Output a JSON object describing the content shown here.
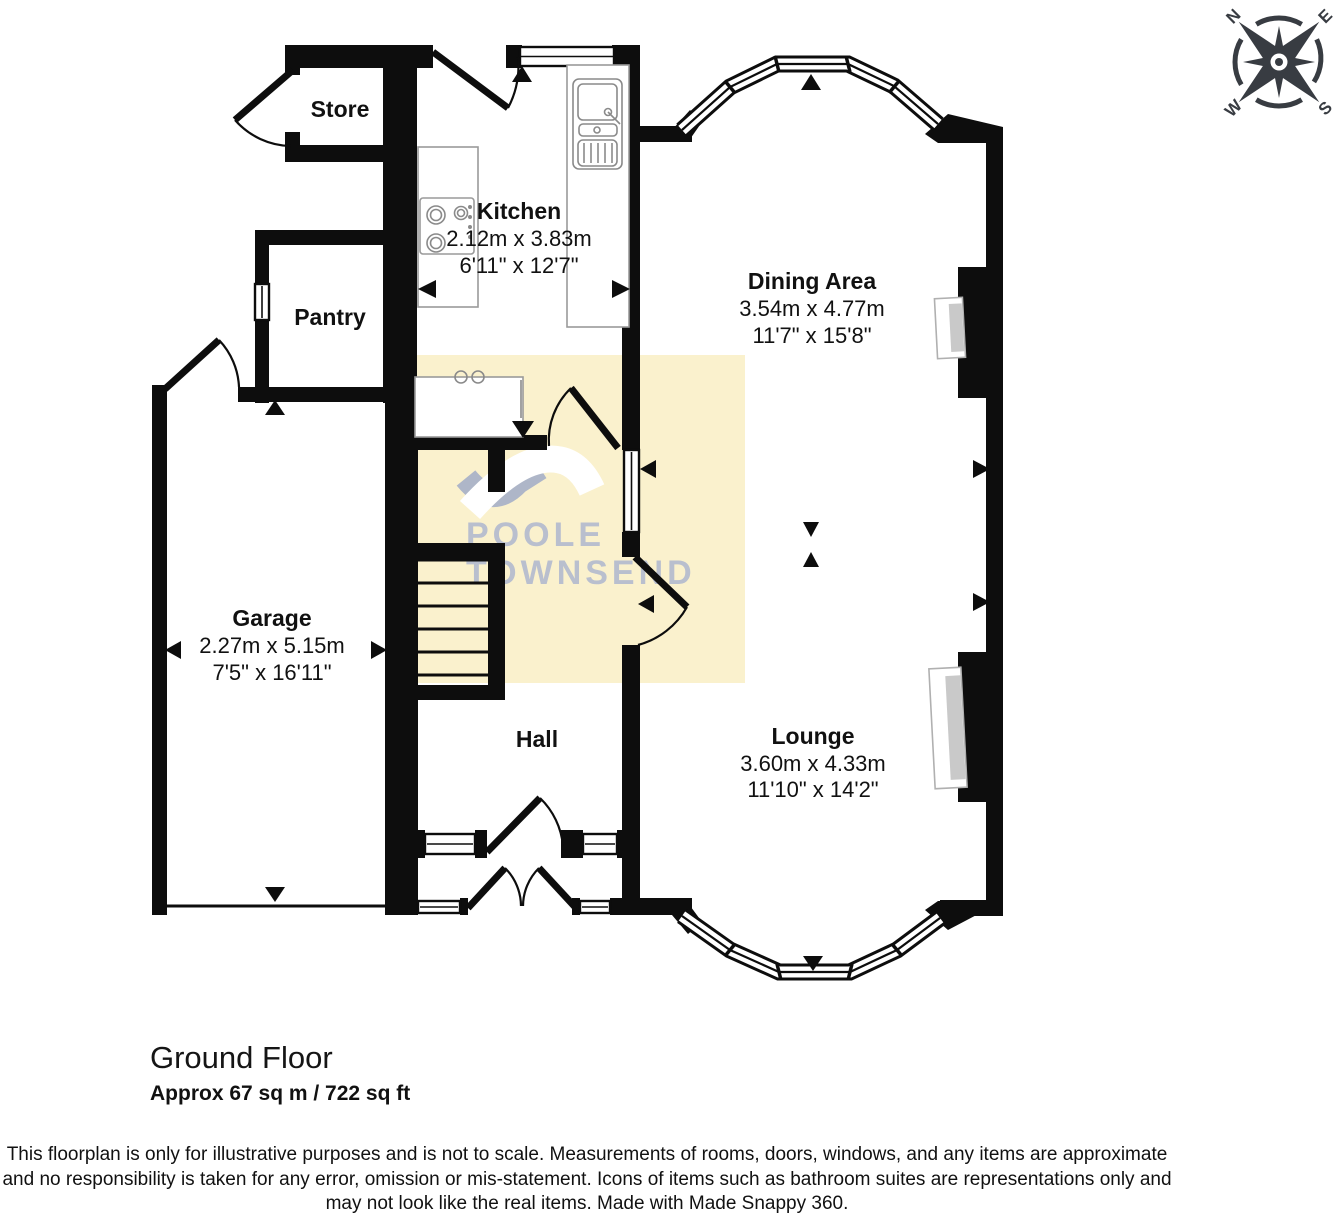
{
  "rooms": {
    "store": {
      "name": "Store"
    },
    "kitchen": {
      "name": "Kitchen",
      "metric": "2.12m x 3.83m",
      "imperial": "6'11\" x 12'7\""
    },
    "pantry": {
      "name": "Pantry"
    },
    "dining": {
      "name": "Dining Area",
      "metric": "3.54m x 4.77m",
      "imperial": "11'7\" x 15'8\""
    },
    "garage": {
      "name": "Garage",
      "metric": "2.27m x 5.15m",
      "imperial": "7'5\" x 16'11\""
    },
    "hall": {
      "name": "Hall"
    },
    "lounge": {
      "name": "Lounge",
      "metric": "3.60m x 4.33m",
      "imperial": "11'10\" x 14'2\""
    }
  },
  "compass": {
    "north": "N",
    "east": "E",
    "south": "S",
    "west": "W"
  },
  "watermark": {
    "line1": "POOLE",
    "line2": "TOWNSEND"
  },
  "footer": {
    "floor_title": "Ground Floor",
    "floor_area": "Approx 67 sq m / 722 sq ft",
    "disclaimer_line1": "This floorplan is only for illustrative purposes and is not to scale. Measurements of rooms, doors, windows, and any items are approximate",
    "disclaimer_line2": "and no responsibility is taken for any error, omission or mis-statement. Icons of items such as bathroom suites are representations only and",
    "disclaimer_line3": "may not look like the real items. Made with Made Snappy 360."
  },
  "icons": {
    "compass_rose": "8-point compass star",
    "measure_arrow": "solid triangle",
    "fireplace": "chimney-breast recess",
    "sink": "double bowl sink with drainer",
    "hob": "4-ring hob",
    "stairs": "staircase treads"
  },
  "colors": {
    "wall": "#0d0d0d",
    "highlight": "#faf1cd",
    "logo": "#b6bdcf",
    "compass": "#383c42",
    "fireplace_inner": "#c9c9c9"
  }
}
